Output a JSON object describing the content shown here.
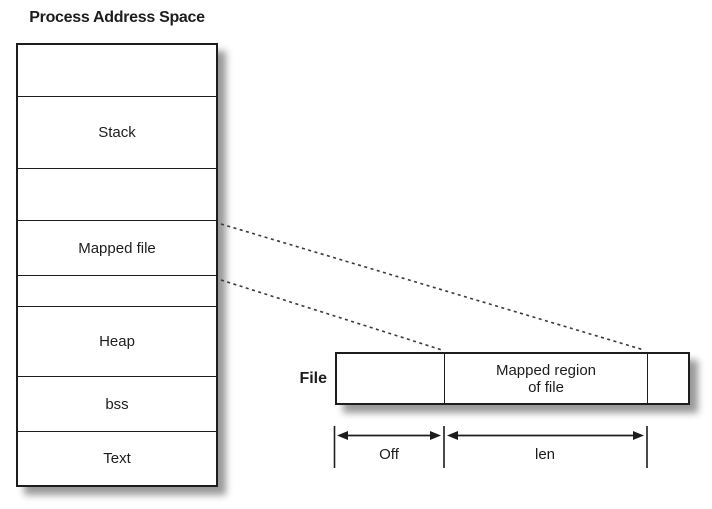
{
  "title": "Process Address Space",
  "address_space": {
    "segments": [
      {
        "label": ""
      },
      {
        "label": "Stack"
      },
      {
        "label": ""
      },
      {
        "label": "Mapped file"
      },
      {
        "label": ""
      },
      {
        "label": "Heap"
      },
      {
        "label": "bss"
      },
      {
        "label": "Text"
      }
    ]
  },
  "file": {
    "label": "File",
    "regions": [
      {
        "label": ""
      },
      {
        "label_lines": [
          "Mapped region",
          "of file"
        ]
      },
      {
        "label": ""
      }
    ]
  },
  "dimensions": {
    "off": "Off",
    "len": "len"
  },
  "colors": {
    "line": "#1d1d1b",
    "background": "#ffffff",
    "shadow": "rgba(0,0,0,0.40)"
  }
}
